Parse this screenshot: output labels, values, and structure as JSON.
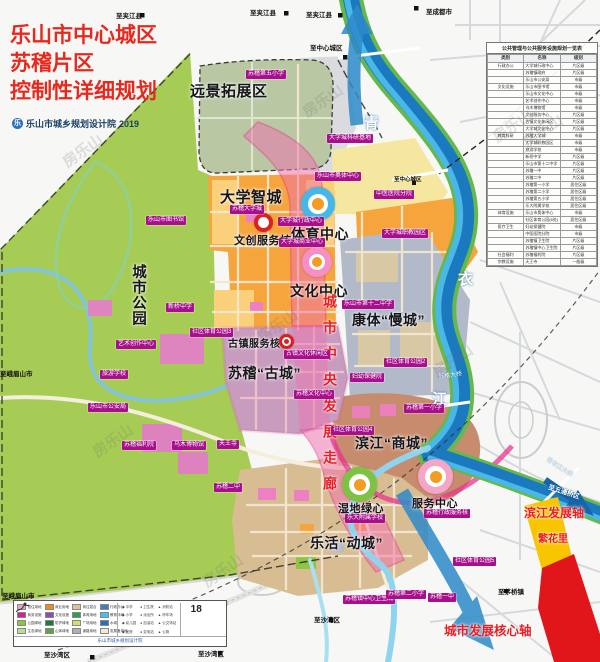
{
  "title": {
    "line1": "乐山市中心城区",
    "line2": "苏稽片区",
    "line3": "控制性详细规划",
    "agency": "乐山市城乡规划设计院",
    "year": "2019",
    "logo_glyph": "乐"
  },
  "big_labels": {
    "expansion": "远景拓展区",
    "university": "大学智城",
    "sports": "体育中心",
    "culture": "文化中心",
    "slow_city": "康体“慢城”",
    "ancient_city": "苏稽“古城”",
    "commercial_city": "滨江“商城”",
    "active_city": "乐活“动城”",
    "city_park": "城市公园",
    "creative_core": "文创服务核",
    "ancient_core": "古镇服务核",
    "wetland_core": "湿地绿心",
    "service_center": "服务中心"
  },
  "axis_labels": {
    "central_corridor": "城市中央发展走廊",
    "riverside_axis": "滨江发展轴",
    "core_axis": "城市发展核心轴",
    "fanhuali": "繁花里"
  },
  "river": {
    "char1": "青",
    "char2": "衣",
    "char3": "江",
    "bridge1": "苏稽大桥",
    "bridge2": "青衣江大桥",
    "railway": "成昆铁路复线"
  },
  "facilities": [
    {
      "t": "苏稽第五小学",
      "x": 246,
      "y": 70
    },
    {
      "t": "大学城科研基地",
      "x": 327,
      "y": 134
    },
    {
      "t": "乐山市奥体中心",
      "x": 315,
      "y": 172
    },
    {
      "t": "苏稽大学城",
      "x": 230,
      "y": 205
    },
    {
      "t": "大学城行政中心",
      "x": 278,
      "y": 217
    },
    {
      "t": "大学城商业中心",
      "x": 279,
      "y": 238
    },
    {
      "t": "中医医院分院",
      "x": 374,
      "y": 190
    },
    {
      "t": "大学城职教园区",
      "x": 382,
      "y": 229
    },
    {
      "t": "乐山市图书馆",
      "x": 146,
      "y": 216
    },
    {
      "t": "新桥中学",
      "x": 166,
      "y": 303
    },
    {
      "t": "社区体育公园3",
      "x": 190,
      "y": 328
    },
    {
      "t": "艺术创作中心",
      "x": 116,
      "y": 340
    },
    {
      "t": "旅游学校",
      "x": 100,
      "y": 370
    },
    {
      "t": "乐山市公安局",
      "x": 88,
      "y": 403
    },
    {
      "t": "苏稽福利院",
      "x": 122,
      "y": 441
    },
    {
      "t": "乌木博物馆",
      "x": 172,
      "y": 441
    },
    {
      "t": "天王寺",
      "x": 217,
      "y": 440
    },
    {
      "t": "苏稽二中",
      "x": 214,
      "y": 483
    },
    {
      "t": "乐山市第十二中学",
      "x": 342,
      "y": 300
    },
    {
      "t": "社区体育公园2",
      "x": 384,
      "y": 358
    },
    {
      "t": "妇幼保健院",
      "x": 350,
      "y": 373
    },
    {
      "t": "古镇文化休闲区",
      "x": 284,
      "y": 350
    },
    {
      "t": "苏稽文化中心",
      "x": 294,
      "y": 390
    },
    {
      "t": "苏稽第一小学",
      "x": 404,
      "y": 404
    },
    {
      "t": "社区体育公园4",
      "x": 331,
      "y": 426
    },
    {
      "t": "乐大附属学校",
      "x": 345,
      "y": 514
    },
    {
      "t": "苏稽行政服务核",
      "x": 424,
      "y": 509
    },
    {
      "t": "社区体育公园5",
      "x": 453,
      "y": 557
    },
    {
      "t": "苏稽镇中心卫生院",
      "x": 343,
      "y": 595
    },
    {
      "t": "苏稽第二小学",
      "x": 386,
      "y": 590
    },
    {
      "t": "苏稽一中",
      "x": 428,
      "y": 593
    }
  ],
  "directions": [
    {
      "t": "至夹江县",
      "x": 116,
      "y": 10
    },
    {
      "t": "至夹江县",
      "x": 250,
      "y": 7
    },
    {
      "t": "至夹江县",
      "x": 306,
      "y": 9
    },
    {
      "t": "至成都市",
      "x": 426,
      "y": 6
    },
    {
      "t": "至中心城区",
      "x": 310,
      "y": 42
    },
    {
      "t": "至中心城区",
      "x": 394,
      "y": 175,
      "s": 1
    },
    {
      "t": "至峨眉山市",
      "x": 0,
      "y": 368
    },
    {
      "t": "至峨眉山市",
      "x": 2,
      "y": 590
    },
    {
      "t": "至沙湾区",
      "x": 44,
      "y": 649
    },
    {
      "t": "至沙湾区",
      "x": 198,
      "y": 648
    },
    {
      "t": "至沙湾区",
      "x": 314,
      "y": 614
    },
    {
      "t": "至茅桥镇",
      "x": 498,
      "y": 586
    },
    {
      "t": "至五通桥区",
      "x": 548,
      "y": 486,
      "c": "white",
      "r": 18
    }
  ],
  "table": {
    "title": "公共管理与公共服务设施规划一览表",
    "headers": [
      "类别",
      "名称",
      "级别"
    ],
    "rows": [
      [
        "行政办公",
        "大学城行政中心",
        "片区级"
      ],
      [
        "行政办公",
        "苏稽镇政府",
        "片区级"
      ],
      [
        "行政办公",
        "乐山市公安局",
        "市级"
      ],
      [
        "文化设施",
        "乐山市图书馆",
        "市级"
      ],
      [
        "文化设施",
        "乐山市文化中心",
        "市级"
      ],
      [
        "文化设施",
        "艺术创作中心",
        "市级"
      ],
      [
        "文化设施",
        "乌木博物馆",
        "市级"
      ],
      [
        "文化设施",
        "文创服务中心",
        "片区级"
      ],
      [
        "文化设施",
        "古镇文化休闲区",
        "片区级"
      ],
      [
        "文化设施",
        "大学城文化中心",
        "片区级"
      ],
      [
        "教育科研",
        "苏稽大学城",
        "市级"
      ],
      [
        "教育科研",
        "大学城职教园区",
        "市级"
      ],
      [
        "教育科研",
        "旅游学校",
        "市级"
      ],
      [
        "教育科研",
        "新桥中学",
        "片区级"
      ],
      [
        "教育科研",
        "乐山市第十二中学",
        "片区级"
      ],
      [
        "教育科研",
        "苏稽一中",
        "片区级"
      ],
      [
        "教育科研",
        "苏稽二中",
        "片区级"
      ],
      [
        "教育科研",
        "苏稽第一小学",
        "居住区级"
      ],
      [
        "教育科研",
        "苏稽第二小学",
        "居住区级"
      ],
      [
        "教育科研",
        "苏稽第五小学",
        "居住区级"
      ],
      [
        "教育科研",
        "乐大附属学校",
        "居住区级"
      ],
      [
        "体育设施",
        "乐山市奥体中心",
        "市级"
      ],
      [
        "体育设施",
        "社区体育公园(6处)",
        "居住区级"
      ],
      [
        "医疗卫生",
        "妇幼保健院",
        "市级"
      ],
      [
        "医疗卫生",
        "中医医院分院",
        "市级"
      ],
      [
        "医疗卫生",
        "苏稽镇卫生院",
        "片区级"
      ],
      [
        "医疗卫生",
        "苏稽镇中心卫生院",
        "片区级"
      ],
      [
        "社会福利",
        "苏稽福利院",
        "片区级"
      ],
      [
        "宗教设施",
        "天王寺",
        "一般级"
      ]
    ]
  },
  "legend": {
    "items": [
      {
        "c": "#f2a0be",
        "t": "居住用地"
      },
      {
        "c": "#f08c1e",
        "t": "商业用地"
      },
      {
        "c": "#d9c49c",
        "t": "商住混合"
      },
      {
        "c": "#3f7fc1",
        "t": "行政办公"
      },
      {
        "c": "#d81e8e",
        "t": "商务设施"
      },
      {
        "c": "#8e4bbf",
        "t": "文化设施"
      },
      {
        "c": "#2e9e57",
        "t": "体育用地"
      },
      {
        "c": "#43c3e8",
        "t": "教育科研"
      },
      {
        "c": "#8cc63f",
        "t": "公园绿地"
      },
      {
        "c": "#1f7a33",
        "t": "防护绿地"
      },
      {
        "c": "#cfe36a",
        "t": "广场用地"
      },
      {
        "c": "#2a6fbd",
        "t": "水域"
      },
      {
        "c": "#b8e08c",
        "t": "生态绿地"
      },
      {
        "c": "#57a544",
        "t": "山体绿地"
      },
      {
        "c": "#b0b0b0",
        "t": "道路用地"
      },
      {
        "c": "#f2e9d8",
        "t": "发展备用地"
      }
    ],
    "extra_cols": [
      [
        "◆ 中学",
        "◆ 小学",
        "◆ 幼儿园",
        "◆ 医院"
      ],
      [
        "● 卫生院",
        "● 派出所",
        "● 加油站",
        "● 变电站"
      ],
      [
        "▲ 消防站",
        "▲ 停车场",
        "▲ 公交场站",
        "▲ 公厕"
      ]
    ],
    "number": "18",
    "foot": "乐山市城乡规划设计院"
  },
  "watermark": {
    "text": "房乐山"
  }
}
